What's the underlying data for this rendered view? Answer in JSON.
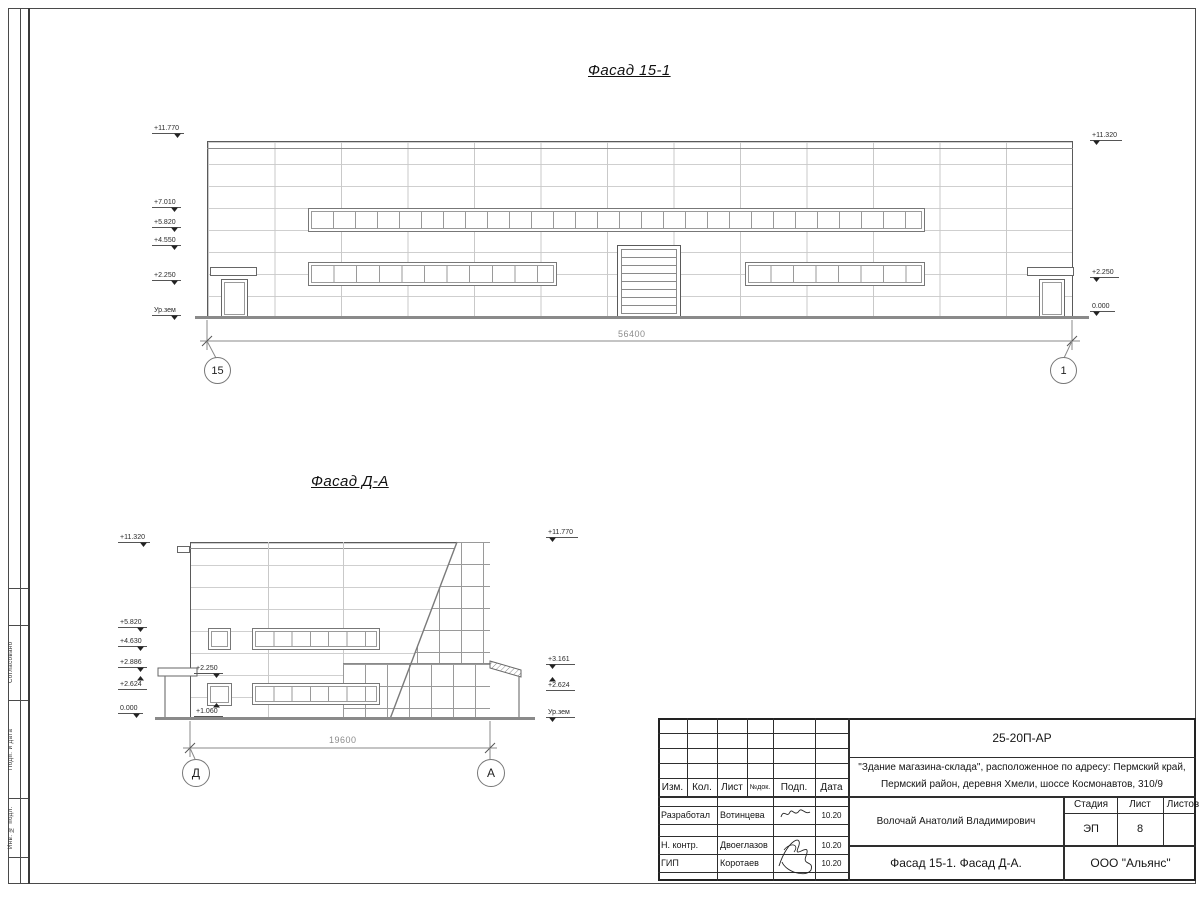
{
  "sheet": {
    "side_labels": [
      "Согласовано",
      "Подп. и дата",
      "Инв. № подл."
    ]
  },
  "facade1": {
    "title": "Фасад 15-1",
    "marks_left": [
      "+11.770",
      "+7.010",
      "+5.820",
      "+4.550",
      "+2.250",
      "Ур.зем"
    ],
    "marks_right": [
      "+11.320",
      "+2.250",
      "0.000"
    ],
    "dimension": "56400",
    "axis_left": "15",
    "axis_right": "1"
  },
  "facade2": {
    "title": "Фасад Д-А",
    "marks_left": [
      "+11.320",
      "+5.820",
      "+4.630",
      "+2.886",
      "+2.624",
      "0.000"
    ],
    "marks_right": [
      "+11.770",
      "+3.161",
      "+2.624",
      "Ур.зем"
    ],
    "mark_window_top": "+2.250",
    "mark_window_bottom": "+1.060",
    "dimension": "19600",
    "axis_left": "Д",
    "axis_right": "А"
  },
  "titleblock": {
    "doc_number": "25-20П-АР",
    "project_line1": "\"Здание магазина-склада\", расположенное по адресу: Пермский край,",
    "project_line2": "Пермский район, деревня Хмели, шоссе Космонавтов, 310/9",
    "col_izm": "Изм.",
    "col_kol": "Кол.",
    "col_list": "Лист",
    "col_ndok": "№док.",
    "col_podp": "Подп.",
    "col_data": "Дата",
    "row1_role": "Разработал",
    "row1_name": "Вотинцева",
    "row1_date": "10.20",
    "row2_role": "Н. контр.",
    "row2_name": "Двоеглазов",
    "row2_date": "10.20",
    "row3_role": "ГИП",
    "row3_name": "Коротаев",
    "row3_date": "10.20",
    "approver": "Волочай Анатолий Владимирович",
    "stage_label": "Стадия",
    "list_label": "Лист",
    "listov_label": "Листов",
    "stage_value": "ЭП",
    "list_value": "8",
    "drawing_title": "Фасад 15-1. Фасад Д-А.",
    "company": "ООО \"Альянс\""
  }
}
